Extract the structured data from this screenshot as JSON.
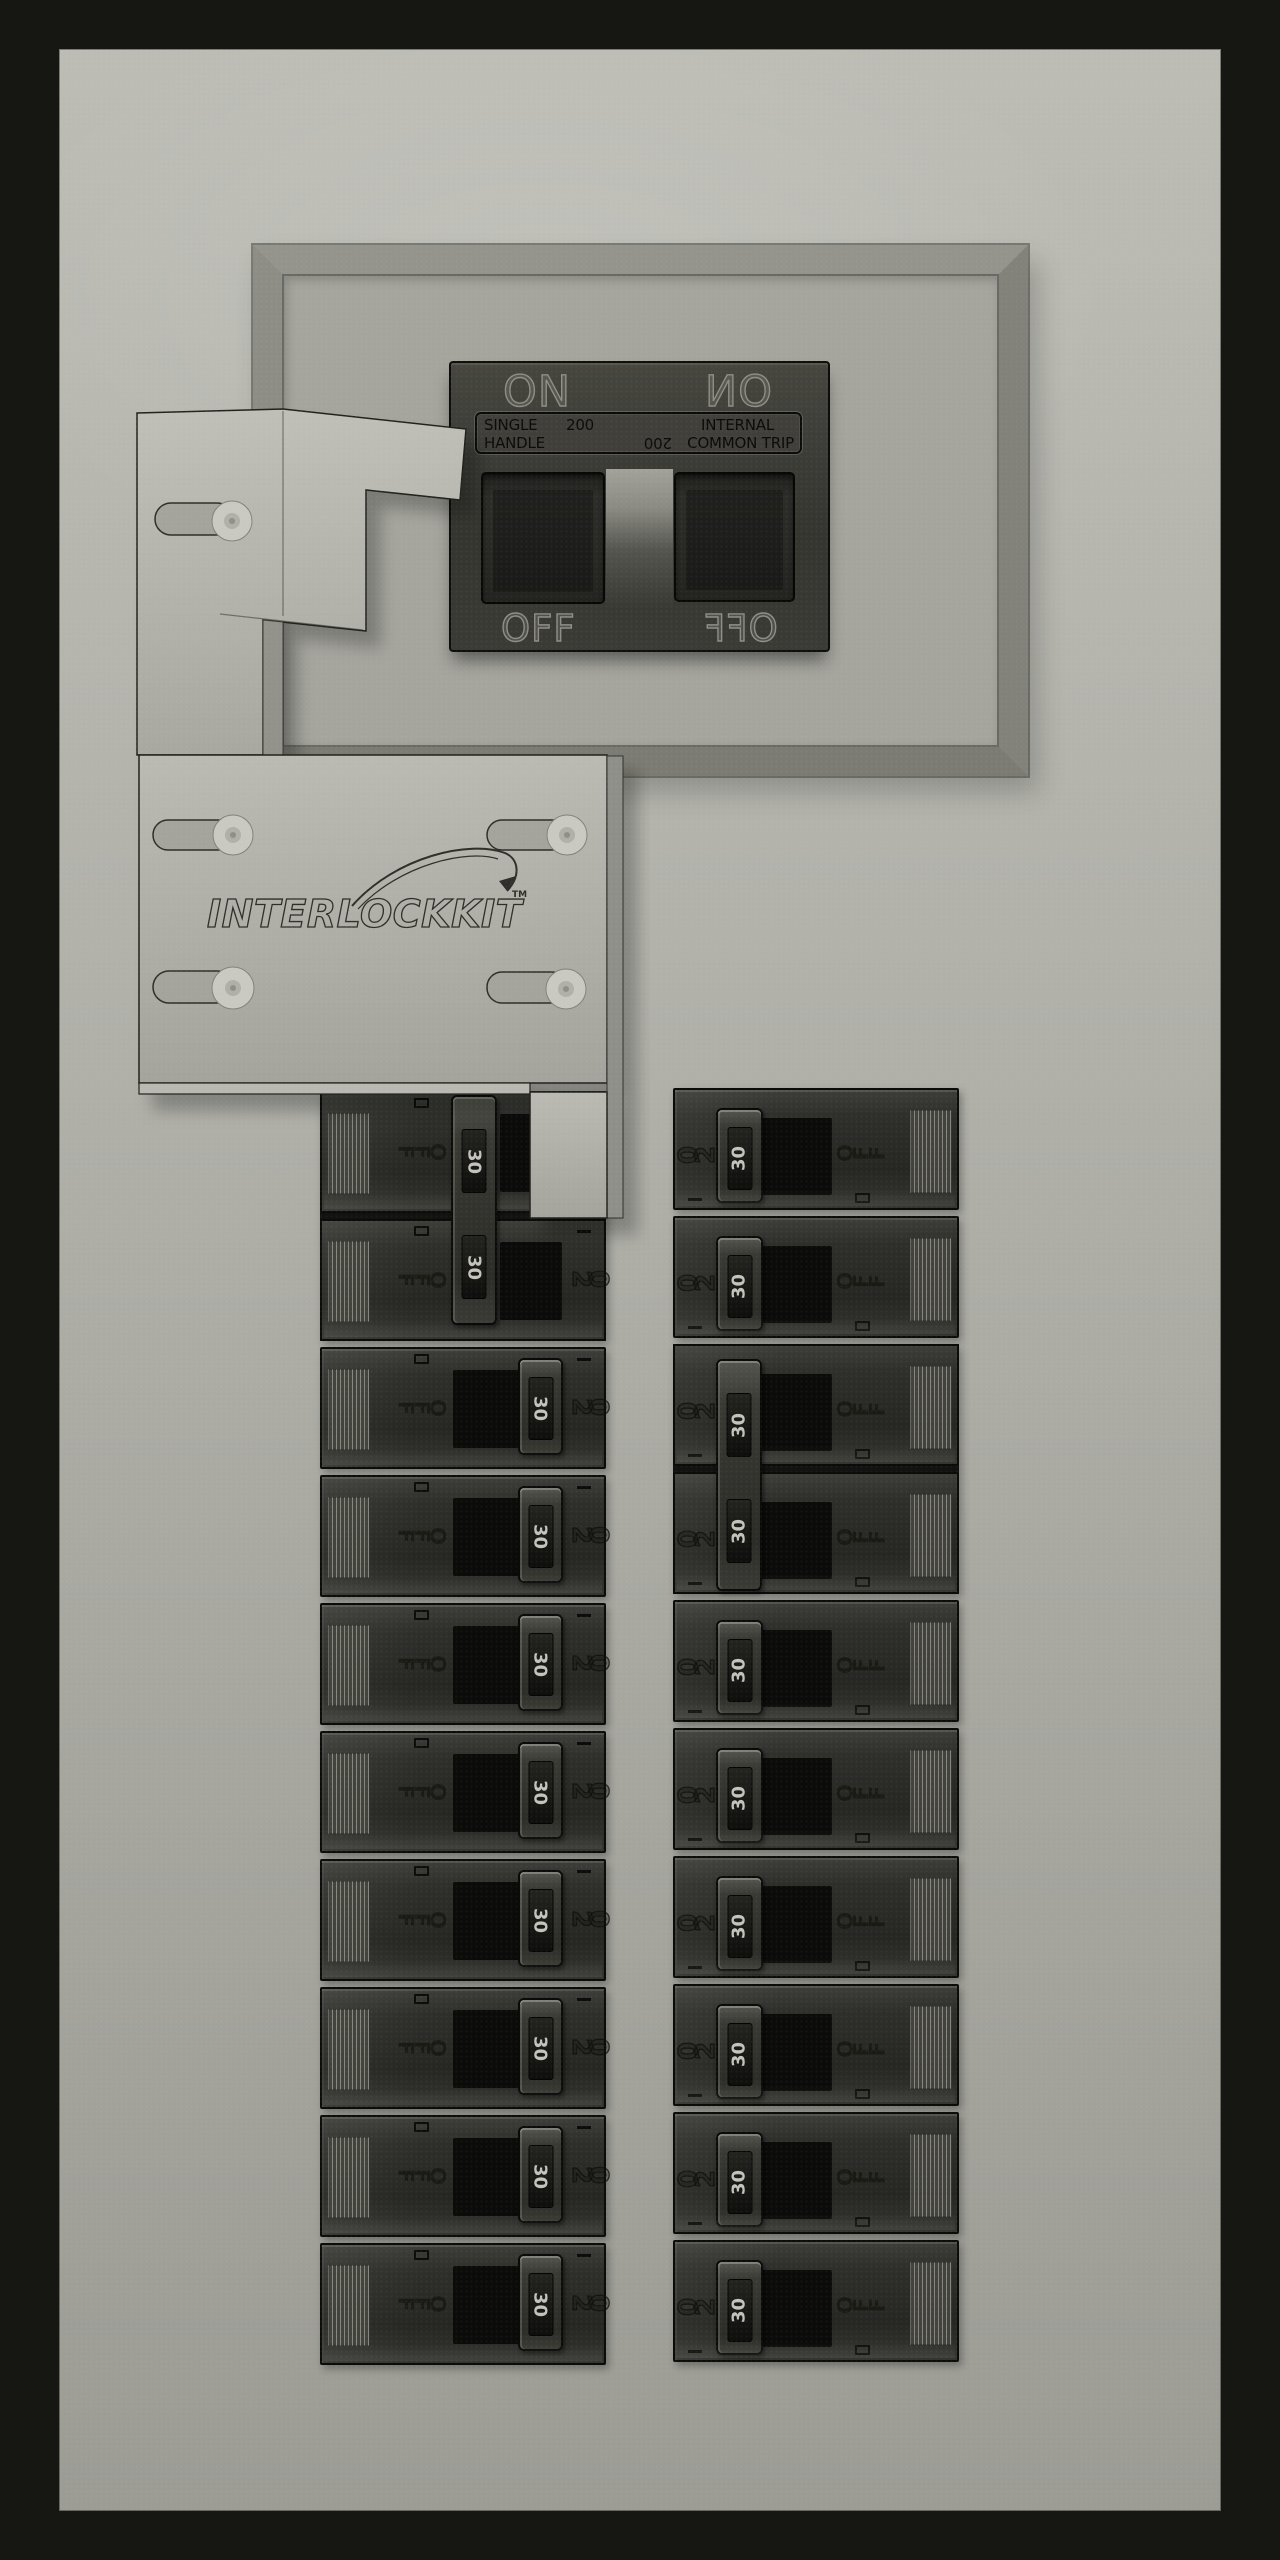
{
  "colors": {
    "cabinet_border": "#161613",
    "panel_top": "#bcbcb5",
    "panel_bottom": "#9c9c95",
    "frame_gray": "#87877f",
    "recess_gray": "#a5a59e",
    "breaker_body": "#2e2e2b",
    "bracket_gray": "#b5b5ae",
    "handle_black": "#121210",
    "handle_rating_text": "#c3c3bb",
    "molded_text_dark": "#15150f",
    "label_text": "#0b0b09"
  },
  "main_breaker": {
    "on_label": "ON",
    "off_label": "OFF",
    "label_plate": {
      "left_line1": "SINGLE",
      "left_line2": "HANDLE",
      "rating": "200",
      "right_line1": "INTERNAL",
      "right_line2": "COMMON TRIP"
    }
  },
  "interlock_kit": {
    "logo_text": "INTERLOCKKIT",
    "trademark": "TM"
  },
  "branch_breakers": {
    "handle_rating": "30",
    "body_rating": "20",
    "off_label": "OFF",
    "columns": {
      "left": {
        "rows": 10,
        "tied_pair_start_row": 1,
        "handle_side": "right"
      },
      "right": {
        "rows": 10,
        "tied_pair_start_row": 3,
        "handle_side": "left"
      }
    }
  }
}
